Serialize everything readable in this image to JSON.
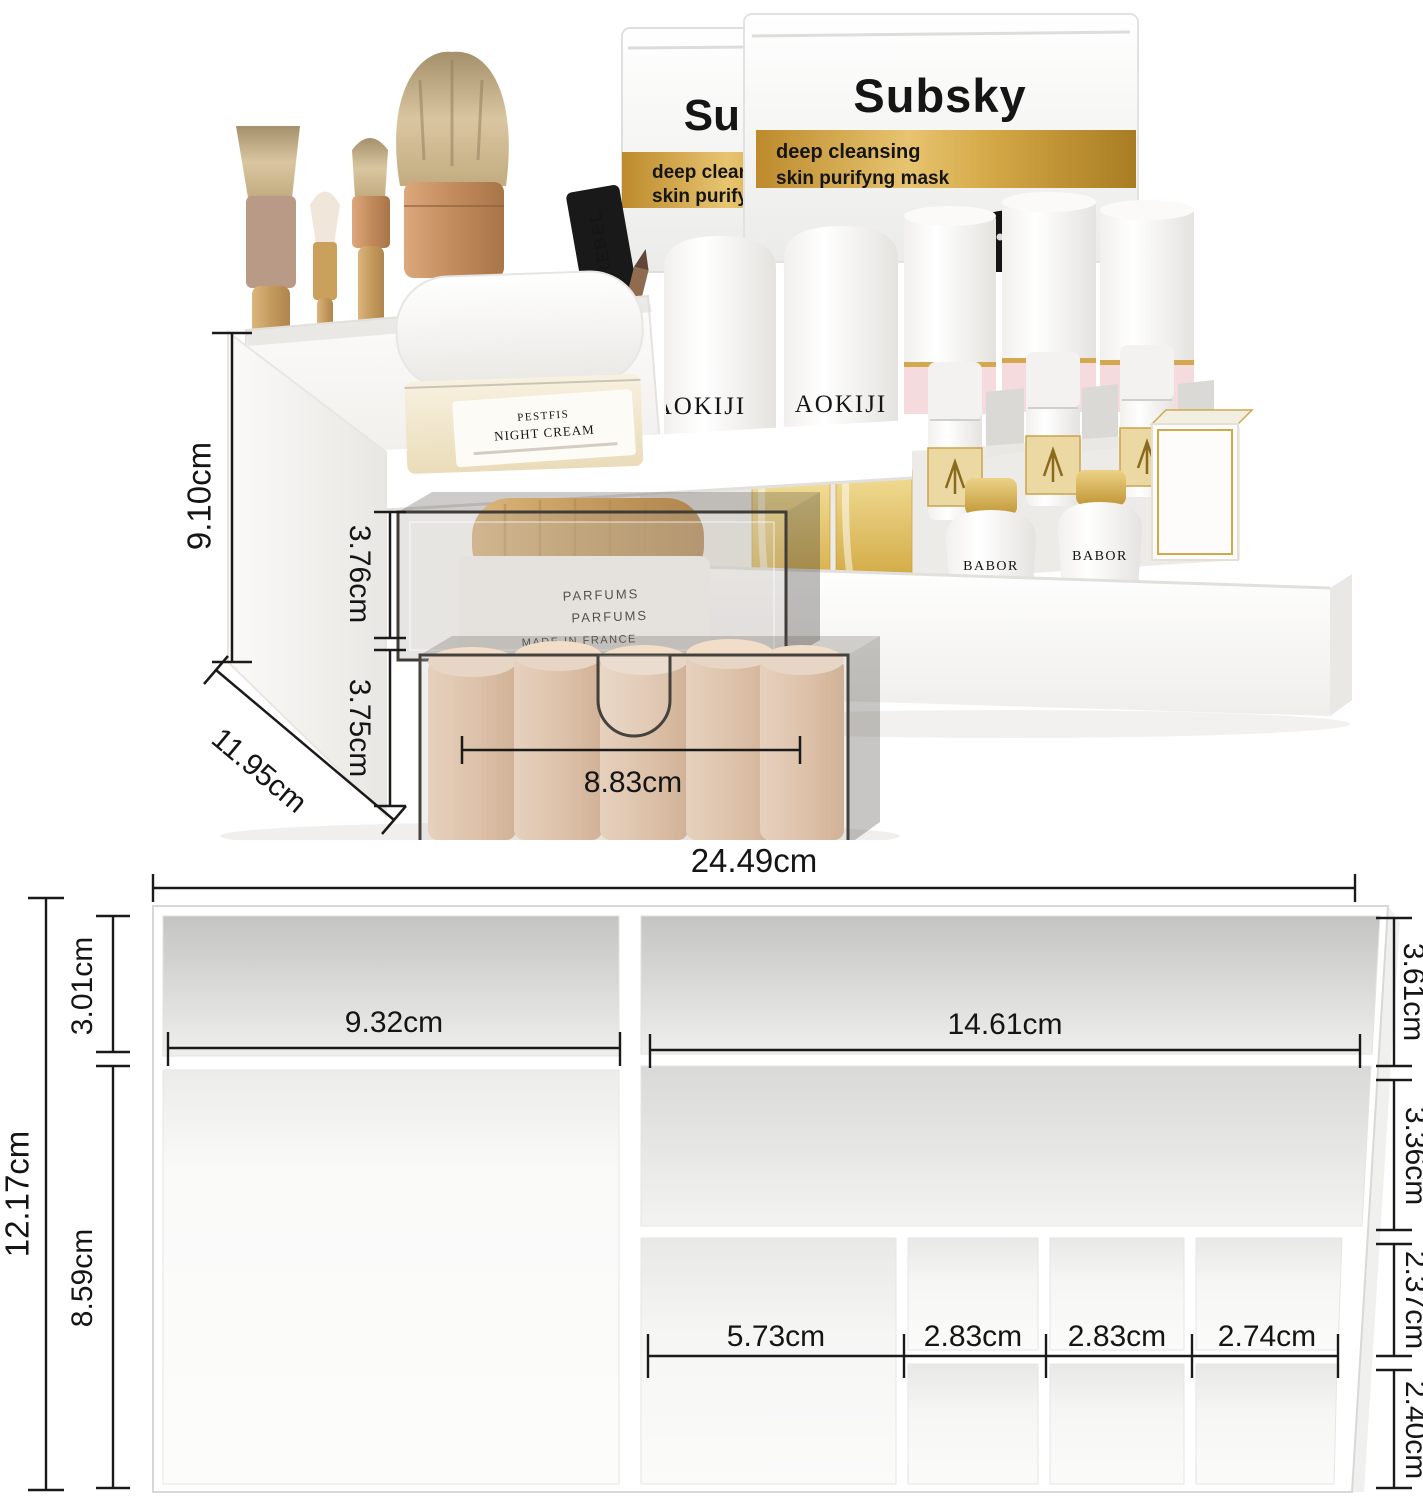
{
  "photo": {
    "masks": {
      "brand": "Subsky",
      "band_line1": "deep cleansing",
      "band_line2": "skin purifyng mask",
      "band_color": "#c79534"
    },
    "night_cream": {
      "line1": "PESTFIS",
      "line2": "NIGHT CREAM"
    },
    "mascara": {
      "label": "REBEL"
    },
    "parfum_jar": {
      "line1": "PARFUMS",
      "line2": "PARFUMS",
      "line3": "MADE IN FRANCE"
    },
    "serum": {
      "brand": "AOKIJI"
    },
    "babor": {
      "brand": "BABOR"
    },
    "dims": {
      "height": "9.10cm",
      "drawer1_height": "3.76cm",
      "drawer2_height": "3.75cm",
      "depth": "11.95cm",
      "drawer_width": "8.83cm"
    }
  },
  "diagram": {
    "dims": {
      "total_width": "24.49cm",
      "total_depth": "12.17cm",
      "left_back": "3.01cm",
      "left_width": "9.32cm",
      "left_front": "8.59cm",
      "right_width": "14.61cm",
      "right_back": "3.61cm",
      "right_mid": "3.36cm",
      "small_back": "2.37cm",
      "small_front": "2.40cm",
      "cols": [
        "5.73cm",
        "2.83cm",
        "2.83cm",
        "2.74cm"
      ]
    }
  },
  "colors": {
    "mask_gold": "#c79534",
    "wood": "#c9a164",
    "lipstick_beige": "#e3c0a3",
    "gold_cap": "#d4af5e",
    "pink_base": "#f4d9de",
    "dimension_line": "#1a1a1a",
    "organizer_white": "#ffffff"
  }
}
